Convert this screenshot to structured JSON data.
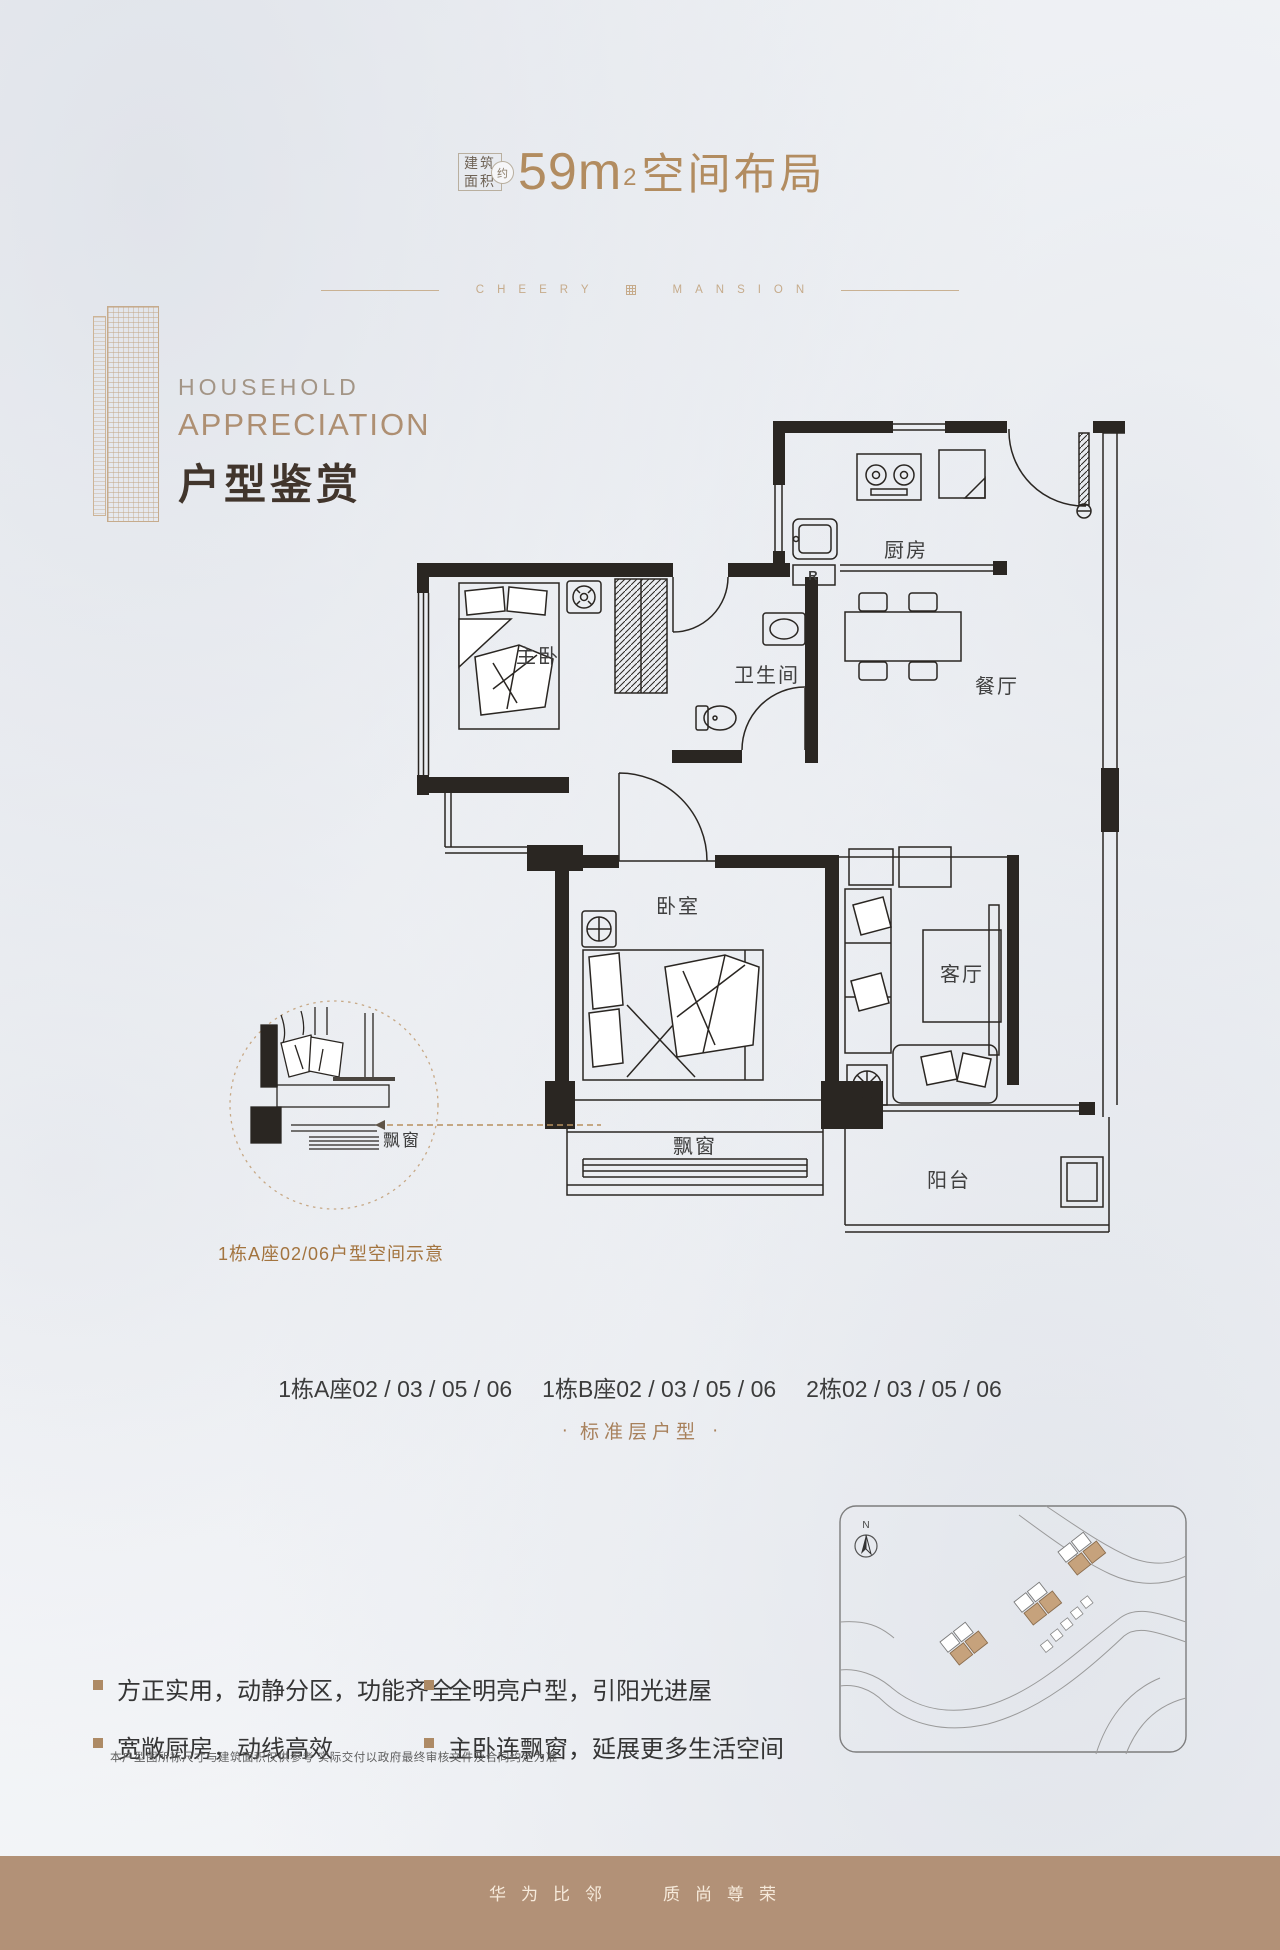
{
  "header": {
    "area_box_line1": "建筑",
    "area_box_line2": "面积",
    "approx_label": "约",
    "area_number": "59m",
    "area_exponent": "2",
    "title_suffix": "空间布局"
  },
  "brand_divider": {
    "left": "CHEERY",
    "right": "MANSION"
  },
  "section_header": {
    "en_top": "HOUSEHOLD",
    "en_bottom": "APPRECIATION",
    "cn": "户型鉴赏"
  },
  "floorplan": {
    "rooms": {
      "kitchen": "厨房",
      "dining": "餐厅",
      "bathroom": "卫生间",
      "master_bedroom": "主卧",
      "bedroom": "卧室",
      "living": "客厅",
      "bay_window": "飘窗",
      "balcony": "阳台"
    },
    "fridge_mark": "R",
    "detail_bubble": {
      "label": "飘窗",
      "caption": "1栋A座02/06户型空间示意"
    }
  },
  "units": {
    "group_a": "1栋A座02 / 03 / 05 / 06",
    "group_b": "1栋B座02 / 03 / 05 / 06",
    "group_c": "2栋02 / 03 / 05 / 06",
    "dot": "·",
    "floor_type": "标准层户型"
  },
  "sitemap": {
    "north": "N"
  },
  "features": {
    "items": [
      {
        "text": "方正实用，动静分区，功能齐全"
      },
      {
        "text": "宽敞厨房，动线高效"
      },
      {
        "text": "全明亮户型，引阳光进屋"
      },
      {
        "text": "主卧连飘窗，延展更多生活空间"
      }
    ]
  },
  "notes": {
    "disclaimer": "本户型图所标尺寸与建筑面积仅供参考  实际交付以政府最终审核文件及合同约定为准"
  },
  "footer": {
    "slogan_a": "华为比邻",
    "slogan_b": "质尚尊荣"
  },
  "colors": {
    "accent": "#b28c60",
    "divider": "#c9b193",
    "ink": "#2a2622",
    "caption": "#a3743f",
    "footer_bg": "#b29177",
    "sitemap_building": "#c6a27c"
  }
}
